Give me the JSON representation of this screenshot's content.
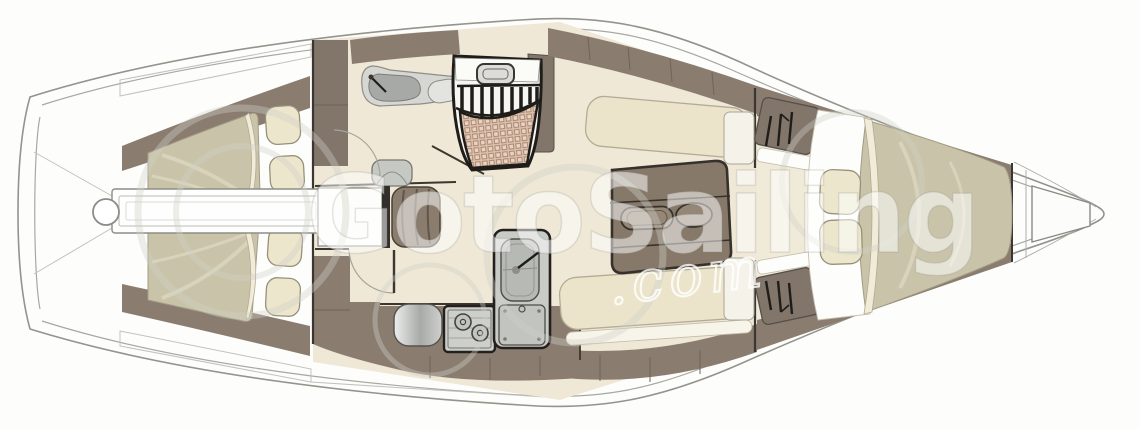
{
  "subject": {
    "type": "sailing-yacht-interior-floor-plan",
    "view": "top-down",
    "bow_direction": "right"
  },
  "watermark": {
    "brand": "GotoSailing",
    "suffix": ".com"
  },
  "palette": {
    "paper": "#fdfdfc",
    "hull_line": "#94948c",
    "wood": "#8a7d70",
    "wood_dark": "#82756a",
    "floor": "#efe8d6",
    "cushion": "#ebe4cb",
    "bed": "#c9c4a9",
    "pillow": "#ece6cc",
    "steel": "#c9cbc7",
    "mat_base": "#d9c0ab",
    "mat_grid": "#a57a67",
    "outline": "#23201d"
  },
  "features": [
    "hull",
    "side-decks",
    "transom",
    "steering-gear",
    "aft-cabin-port-double-berth",
    "aft-cabin-starboard-double-berth",
    "berth-pillows",
    "engine-compartment",
    "head-compartment",
    "head-sink",
    "head-faucet",
    "toilet",
    "head-door",
    "nav-chart-table",
    "nav-seat",
    "aft-cabin-door",
    "companionway-hatch",
    "companionway-steps",
    "entry-mat",
    "companionway-locker",
    "galley-counter",
    "galley-fridge",
    "galley-stove",
    "galley-sink",
    "galley-faucet",
    "salon-port-settee",
    "salon-starboard-settee",
    "salon-folding-table",
    "bulkhead-lockers",
    "forward-cabin-hanging-lockers",
    "hanger-icons",
    "forward-cabin-v-berth",
    "anchor-locker",
    "bow-deck-lines",
    "watermark-circles"
  ]
}
